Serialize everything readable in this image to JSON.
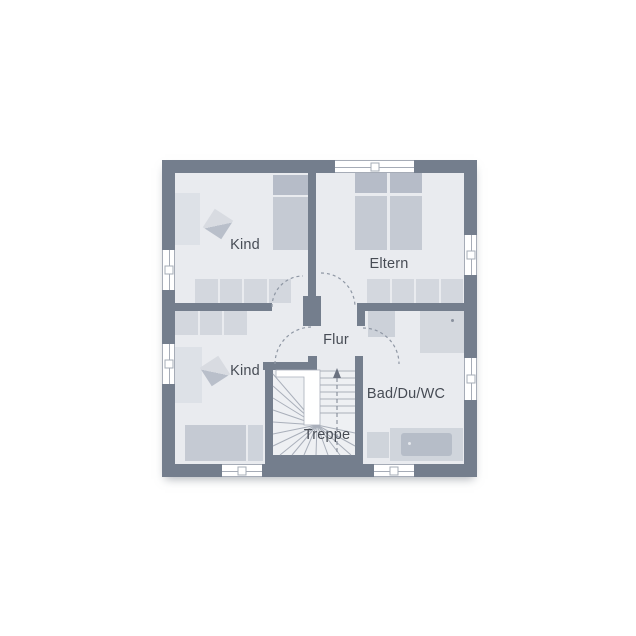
{
  "page": {
    "type": "floor-plan",
    "floor": "upper-floor"
  },
  "labels": {
    "kind_top": "Kind",
    "eltern": "Eltern",
    "flur": "Flur",
    "kind_bottom": "Kind",
    "bad": "Bad/Du/WC",
    "treppe": "Treppe"
  },
  "icons": {
    "stairs_direction": "arrow-up-icon"
  },
  "colors": {
    "wall": "#747e8d",
    "room_fill": "#e9ebef",
    "stairs_fill": "#eef0f3",
    "furniture_light": "#dde1e7",
    "wardrobe": "#d3d7de",
    "bed_mattress": "#c5cad3",
    "bed_pillow": "#b6bcc8",
    "tub_inner": "#b6bdc8",
    "step_line": "#a9afba",
    "door_arc": "#8f97a4",
    "text": "#474c55",
    "background": "#ffffff"
  }
}
